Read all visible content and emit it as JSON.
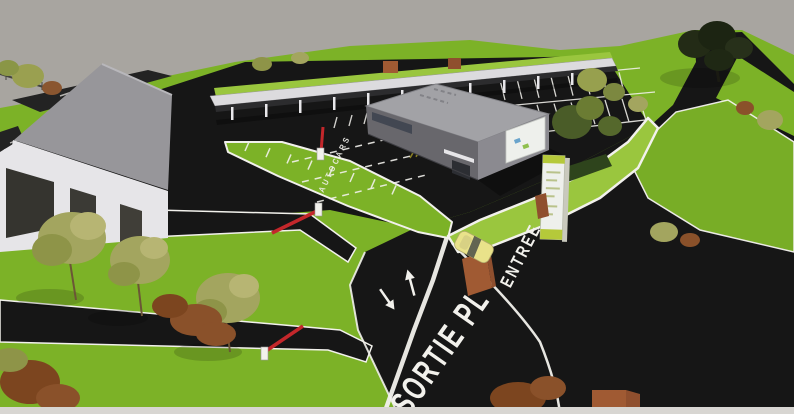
{
  "scene": {
    "type": "3d-architectural-rendering",
    "description": "Aerial 3D rendering of a commercial site: warehouse with loading canopy, carport row, central office building, parking lots, landscaped lawns, barriers and access roads",
    "road_markings": {
      "exit_label": "SORTIE PL",
      "entrance_label": "ENTREE",
      "aisle_label": "AUTOCARS"
    },
    "colors": {
      "sky": "#a8a5a0",
      "grass": "#7cb227",
      "grass_light": "#9ac63e",
      "asphalt": "#161616",
      "marking_white": "#f2f1ec",
      "marking_yellow": "#d6c52f",
      "barrier_red": "#c3272b",
      "car_yellow": "#e9e28a",
      "building_wall": "#68676c",
      "building_end_wall": "#8b8a90",
      "building_roof": "#a2a2a6",
      "canopy_white": "#e6e5e8",
      "brick": "#a05a33",
      "foliage_olive": "#a3a55f",
      "foliage_rust": "#8a512a",
      "foliage_dark": "#232b16",
      "hedge": "#2e441c",
      "totem_white": "#eef0ec",
      "totem_green": "#b5c93a",
      "bottom_strip": "#d8d6d2"
    }
  }
}
